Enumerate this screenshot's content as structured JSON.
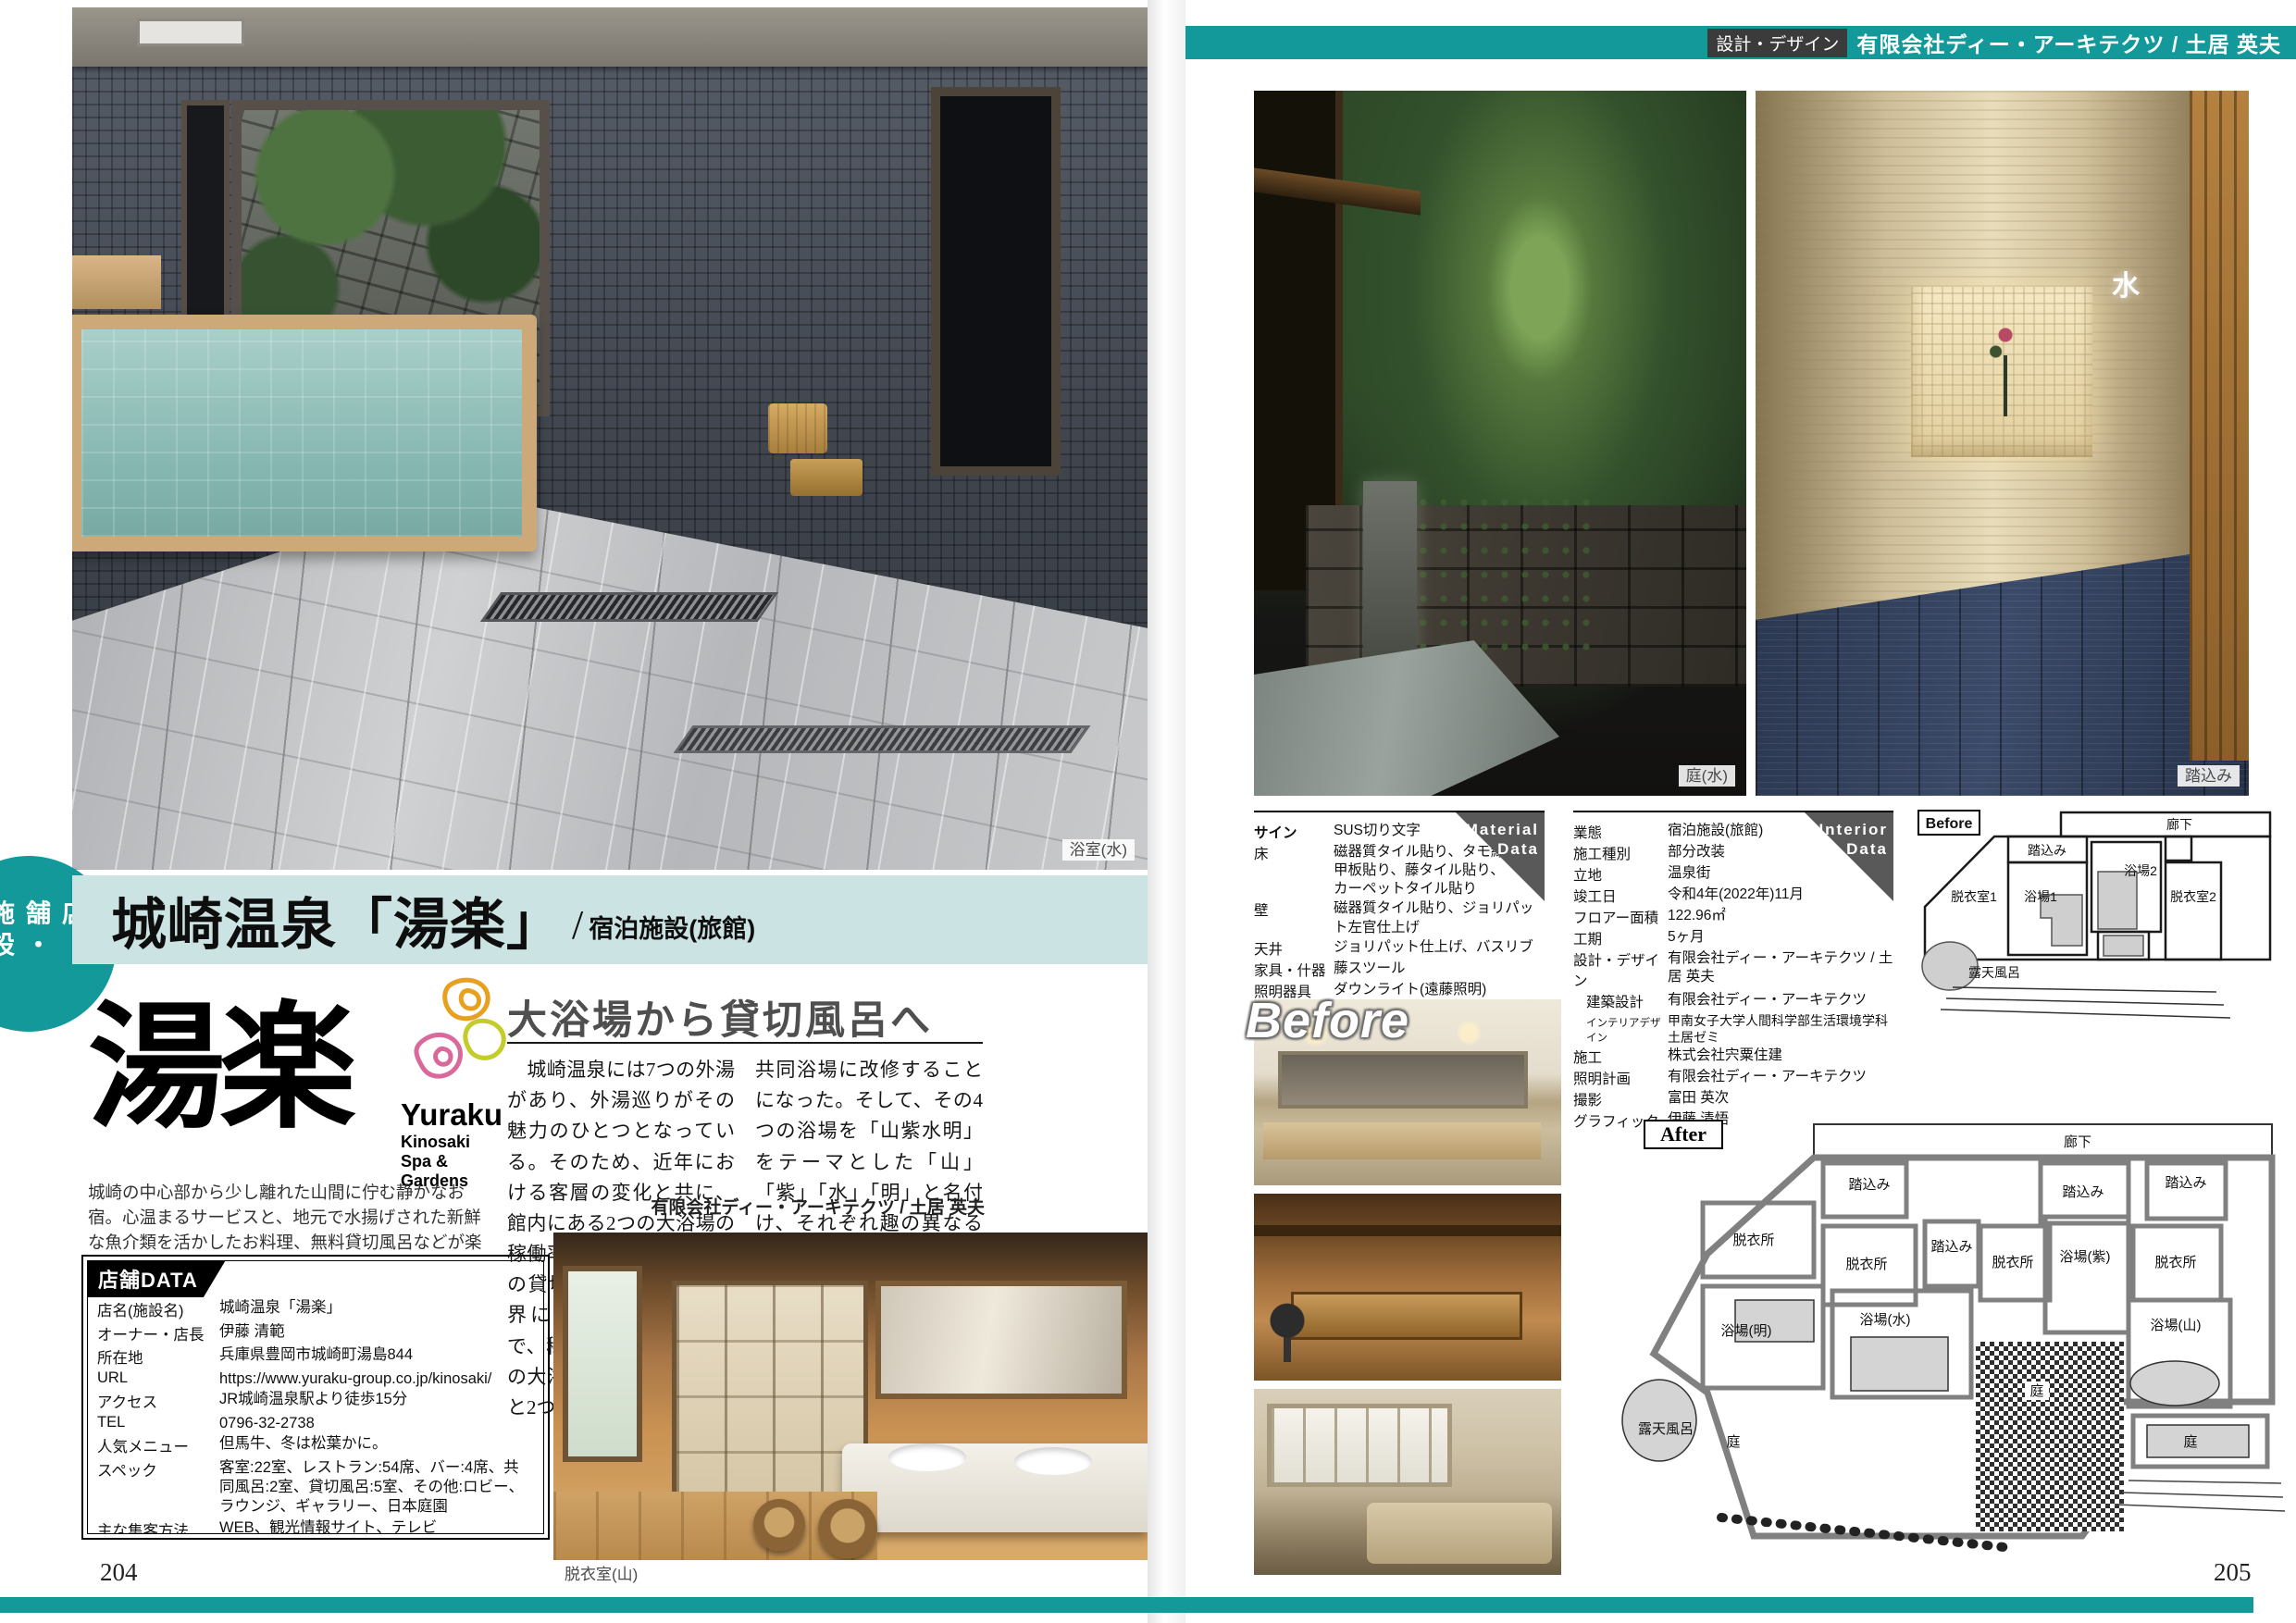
{
  "colors": {
    "accent": "#14999b",
    "band": "#cbe3e2",
    "corner": "#595959",
    "heading_grey": "#4f4f4f"
  },
  "page": {
    "left_number": "204",
    "right_number": "205"
  },
  "sidebar_tab": {
    "label": "店舗・施設"
  },
  "header": {
    "tag": "設計・デザイン",
    "firm": "有限会社ディー・アーキテクツ / 土居 英夫"
  },
  "title": {
    "main": "城崎温泉「湯楽」",
    "slash": "/",
    "category": "宿泊施設(旅館)"
  },
  "logo": {
    "kanji": "湯楽",
    "latin": "Yuraku",
    "sub": "Kinosaki Spa & Gardens"
  },
  "intro": "城崎の中心部から少し離れた山間に佇む静かなお宿。心温まるサービスと、地元で水揚げされた新鮮な魚介類を活かしたお料理、無料貸切風呂などが楽しめる。",
  "article": {
    "heading": "大浴場から貸切風呂へ",
    "col1": "　城崎温泉には7つの外湯があり、外湯巡りがその魅力のひとつとなっている。そのため、近年における客層の変化と共に、館内にある2つの大浴場の稼働率が低下し、既存3つの貸切浴場の稼働率が限界に達していた。そこで、稼働率の低下した2つの大浴場を2つの貸切浴場と2つの",
    "col2": "共同浴場に改修することになった。そして、その4つの浴場を「山紫水明」をテーマとした「山」「紫」「水」「明」と名付け、それぞれ趣の異なる浴場と庭が一体化した空間へと改修した。",
    "byline": "有限会社ディー・アーキテクツ / 土居 英夫"
  },
  "captions": {
    "main_photo": "浴室(水)",
    "garden_photo": "庭(水)",
    "entry_photo": "踏込み",
    "entry_sign": "水",
    "dressing_photo": "脱衣室(山)",
    "before_overlay": "Before"
  },
  "shop_data": {
    "title": "店舗DATA",
    "rows": [
      {
        "label": "店名(施設名)",
        "value": "城崎温泉「湯楽」"
      },
      {
        "label": "オーナー・店長",
        "value": "伊藤 清範"
      },
      {
        "label": "所在地",
        "value": "兵庫県豊岡市城崎町湯島844"
      },
      {
        "label": "URL",
        "value": "https://www.yuraku-group.co.jp/kinosaki/"
      },
      {
        "label": "アクセス",
        "value": "JR城崎温泉駅より徒歩15分"
      },
      {
        "label": "TEL",
        "value": "0796-32-2738"
      },
      {
        "label": "人気メニュー",
        "value": "但馬牛、冬は松葉かに。"
      },
      {
        "label": "スペック",
        "value": "客室:22室、レストラン:54席、バー:4席、共同風呂:2室、貸切風呂:5室、その他:ロビー、ラウンジ、ギャラリー、日本庭園"
      },
      {
        "label": "主な集客方法",
        "value": "WEB、観光情報サイト、テレビ"
      },
      {
        "label": "中心年齢層",
        "value": "30〜50代"
      },
      {
        "label": "平均来店客数/日",
        "value": "45人/日"
      },
      {
        "label": "平均客単価",
        "value": "32,000円"
      },
      {
        "label": "年間の広告費",
        "value": "約1,000万円"
      },
      {
        "label": "コロナ対策",
        "value": "オゾンエアー発生器、アルコール消毒、体温チェック"
      }
    ]
  },
  "material_data": {
    "tag_line1": "Material",
    "tag_line2": "Data",
    "rows": [
      {
        "label": "サイン",
        "value": "SUS切り文字"
      },
      {
        "label": "床",
        "value": "磁器質タイル貼り、タモ縁甲板貼り、藤タイル貼り、カーペットタイル貼り"
      },
      {
        "label": "壁",
        "value": "磁器質タイル貼り、ジョリパット左官仕上げ"
      },
      {
        "label": "天井",
        "value": "ジョリパット仕上げ、バスリブ"
      },
      {
        "label": "家具・什器",
        "value": "藤スツール"
      },
      {
        "label": "照明器具",
        "value": "ダウンライト(遠藤照明)"
      }
    ]
  },
  "interior_data": {
    "tag_line1": "Interior",
    "tag_line2": "Data",
    "rows": [
      {
        "label": "業態",
        "value": "宿泊施設(旅館)"
      },
      {
        "label": "施工種別",
        "value": "部分改装"
      },
      {
        "label": "立地",
        "value": "温泉街"
      },
      {
        "label": "竣工日",
        "value": "令和4年(2022年)11月"
      },
      {
        "label": "フロアー面積",
        "value": "122.96㎡"
      },
      {
        "label": "工期",
        "value": "5ヶ月"
      },
      {
        "label": "設計・デザイン",
        "value": "有限会社ディー・アーキテクツ / 土居 英夫"
      },
      {
        "label": "建築設計",
        "value": "有限会社ディー・アーキテクツ"
      },
      {
        "label": "インテリアデザイン",
        "value": "甲南女子大学人間科学部生活環境学科土居ゼミ"
      },
      {
        "label": "施工",
        "value": "株式会社宍粟住建"
      },
      {
        "label": "照明計画",
        "value": "有限会社ディー・アーキテクツ"
      },
      {
        "label": "撮影",
        "value": "富田 英次"
      },
      {
        "label": "グラフィック",
        "value": "伊藤 清悟"
      }
    ]
  },
  "plans": {
    "before": {
      "tag": "Before",
      "rooms": [
        "廊下",
        "踏込み",
        "浴場1",
        "浴場2",
        "脱衣室1",
        "脱衣室2",
        "露天風呂"
      ]
    },
    "after": {
      "tag": "After",
      "rooms": [
        "廊下",
        "踏込み",
        "踏込み",
        "踏込み",
        "踏込み",
        "脱衣所",
        "脱衣所",
        "脱衣所",
        "脱衣所",
        "浴場(紫)",
        "浴場(山)",
        "浴場(水)",
        "浴場(明)",
        "庭",
        "庭",
        "庭",
        "露天風呂"
      ]
    }
  }
}
